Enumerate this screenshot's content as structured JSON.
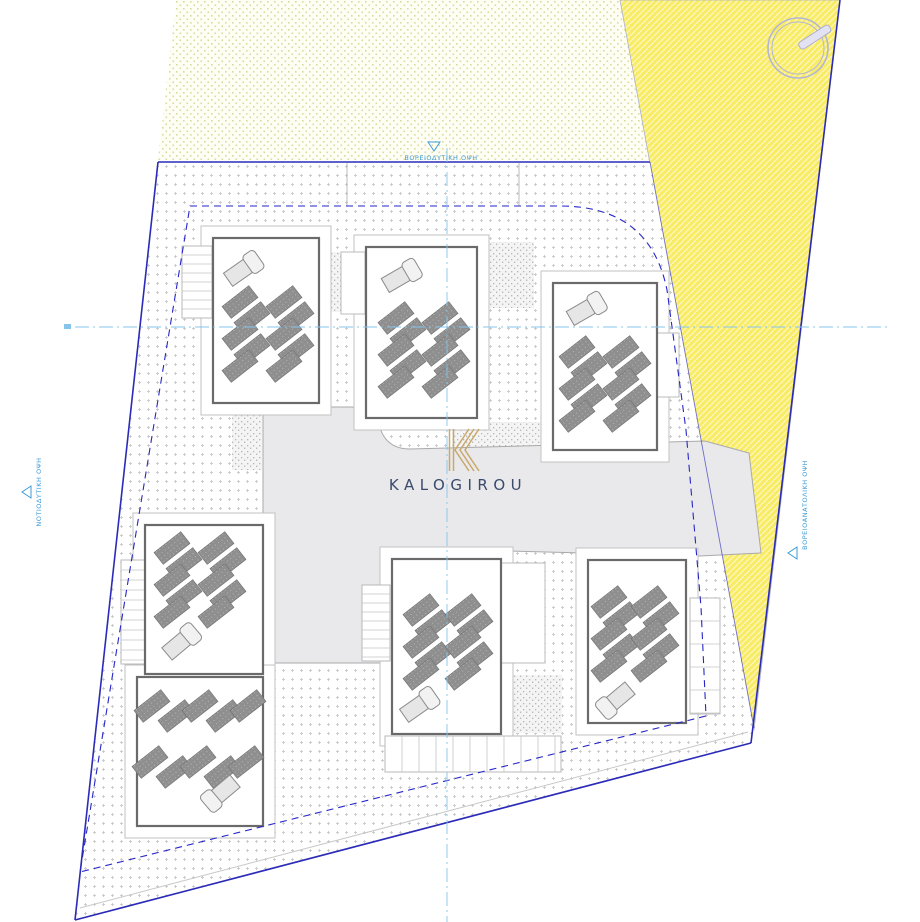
{
  "brand": {
    "name": "KALOGIROU",
    "logo_letter": "K",
    "logo_color": "#c9a96b",
    "name_color": "#3a4a6b"
  },
  "elevation_labels": {
    "top": "ΒΟΡΕΙΟΔΥΤΙΚΗ ΟΨΗ",
    "left": "ΝΟΤΙΟΔΥΤΙΚΗ ΟΨΗ",
    "right": "ΒΟΡΕΙΟΑΝΑΤΟΛΙΚΗ ΟΨΗ",
    "label_color": "#3d9bd8"
  },
  "site": {
    "building_count": 7,
    "boundary_color": "#2b2bb8",
    "setback_line_color": "#2626c8",
    "centerline_color": "#85c5ec",
    "road_color": "#e9e9ec",
    "highlight_parcel_color": "#f8ec67",
    "neighbor_parcel_dot_color": "#d8db9e",
    "solar_panel_color": "#8f8f8f"
  },
  "icons": {
    "north_indicator": "compass-circle-with-needle",
    "elevation_marker": "open-triangle"
  }
}
